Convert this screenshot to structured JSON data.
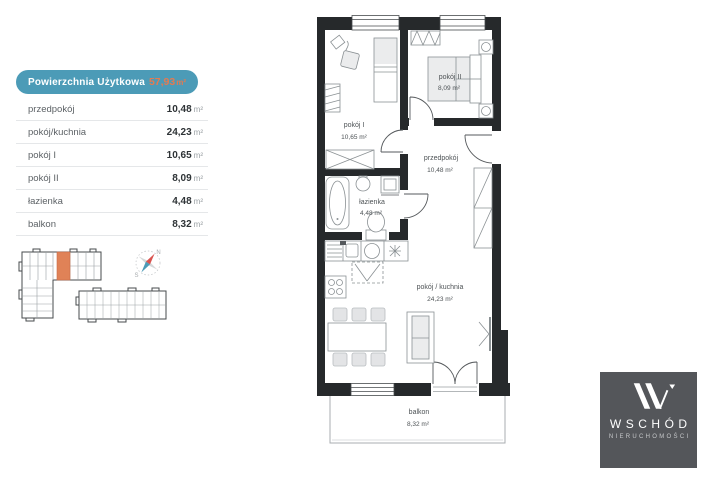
{
  "area_table": {
    "header": {
      "label": "Powierzchnia Użytkowa",
      "value": "57,93",
      "unit": "m²"
    },
    "rows": [
      {
        "label": "przedpokój",
        "value": "10,48",
        "unit": "m²"
      },
      {
        "label": "pokój/kuchnia",
        "value": "24,23",
        "unit": "m²"
      },
      {
        "label": "pokój I",
        "value": "10,65",
        "unit": "m²"
      },
      {
        "label": "pokój II",
        "value": "8,09",
        "unit": "m²"
      },
      {
        "label": "łazienka",
        "value": "4,48",
        "unit": "m²"
      },
      {
        "label": "balkon",
        "value": "8,32",
        "unit": "m²"
      }
    ]
  },
  "floor_plan": {
    "rooms": [
      {
        "name": "pokój I",
        "area": "10,65 m²"
      },
      {
        "name": "pokój II",
        "area": "8,09 m²"
      },
      {
        "name": "przedpokój",
        "area": "10,48 m²"
      },
      {
        "name": "łazienka",
        "area": "4,48 m²"
      },
      {
        "name": "pokój / kuchnia",
        "area": "24,23 m²"
      },
      {
        "name": "balkon",
        "area": "8,32 m²"
      }
    ]
  },
  "compass": {
    "north": "N",
    "south": "S"
  },
  "logo": {
    "name": "WSCHÓD",
    "subtitle": "NIERUCHOMOŚCI"
  },
  "colors": {
    "accent_teal": "#4c9bb7",
    "accent_orange": "#e57a50",
    "highlight_unit": "#e08257",
    "wall": "#26292b",
    "logo_bg": "#54565a"
  }
}
